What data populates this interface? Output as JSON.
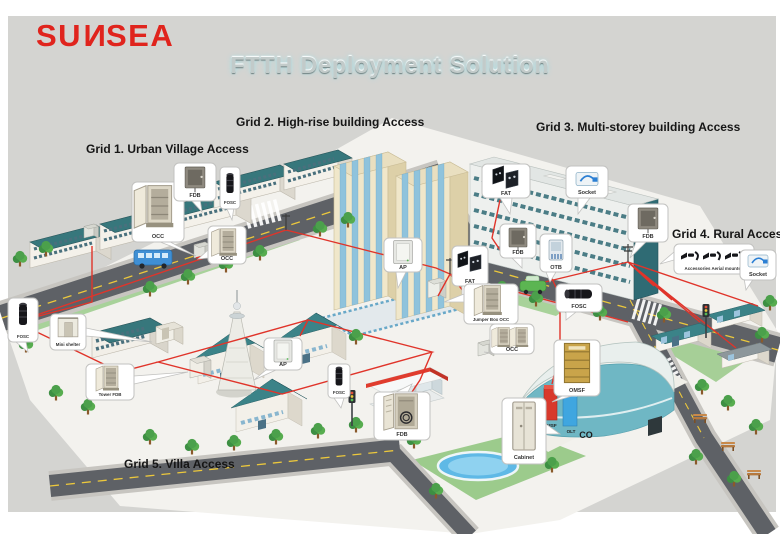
{
  "logo": {
    "p1": "SU",
    "p2": "N",
    "p3": "SE",
    "p4": "A",
    "color": "#e0241d"
  },
  "title": "FTTH Deployment Solution",
  "grid_labels": [
    "Grid 1. Urban Village Access",
    "Grid 2. High-rise building Access",
    "Grid 3. Multi-storey building Access",
    "Grid 4. Rural Access",
    "Grid 5. Villa Access"
  ],
  "callouts": [
    {
      "label": "OCC",
      "device": "street-cabinet"
    },
    {
      "label": "FDB",
      "device": "wall-mounted-box"
    },
    {
      "label": "FOSC",
      "device": "splice-closure-vertical"
    },
    {
      "label": "OCC",
      "device": "street-cabinet"
    },
    {
      "label": "AP",
      "device": "access-point-panel"
    },
    {
      "label": "FAT",
      "device": "fiber-access-terminal"
    },
    {
      "label": "Jumper Box OCC",
      "device": "street-cabinet"
    },
    {
      "label": "FAT",
      "device": "fiber-access-terminal"
    },
    {
      "label": "Socket",
      "device": "fiber-socket"
    },
    {
      "label": "FDB",
      "device": "wall-mounted-box"
    },
    {
      "label": "OTB",
      "device": "optical-terminal-box"
    },
    {
      "label": "FOSC",
      "device": "splice-closure-horizontal"
    },
    {
      "label": "FDB",
      "device": "wall-mounted-box"
    },
    {
      "label": "Accessories Aerial mounted",
      "device": "aerial-hardware"
    },
    {
      "label": "Socket",
      "device": "fiber-socket"
    },
    {
      "label": "FOSC",
      "device": "splice-closure-vertical"
    },
    {
      "label": "Mini shelter",
      "device": "mini-shelter"
    },
    {
      "label": "Tower FDB",
      "device": "street-cabinet"
    },
    {
      "label": "AP",
      "device": "access-point-panel"
    },
    {
      "label": "FOSC",
      "device": "splice-closure-vertical"
    },
    {
      "label": "FDB",
      "device": "distribution-cabinet-open"
    },
    {
      "label": "OCC",
      "device": "street-cabinet-pair"
    },
    {
      "label": "OMSF",
      "device": "splice-frame-rack"
    },
    {
      "label": "Cabinet",
      "device": "indoor-cabinet"
    }
  ],
  "co_site": {
    "co": "CO",
    "omsf": "OMSF",
    "olt": "OLT"
  },
  "colors": {
    "panel_bg": "#d4d4d1",
    "brand_red": "#e0241d",
    "fiber_red": "#e0342a",
    "roof_teal": "#37777c",
    "road_gray": "#5e6166",
    "lane_yellow": "#ecc83c",
    "highrise_cream": "#f0e7ca",
    "glass_blue": "#8fc3dc",
    "grass_green": "#a8d29a"
  }
}
